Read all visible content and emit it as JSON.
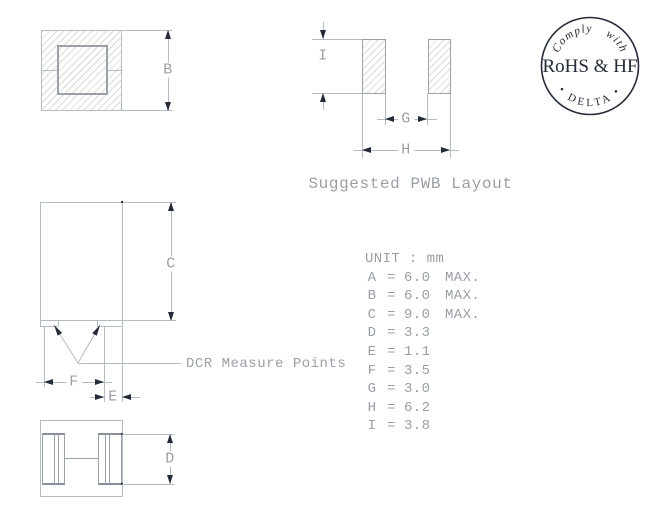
{
  "colors": {
    "line_light": "#b3bbc3",
    "line_mid": "#9aa1a9",
    "ink": "#252b38",
    "text_gray": "#999fa7",
    "hatch": "#d9dbde",
    "background": "#ffffff"
  },
  "views": {
    "top": {
      "dim_b": "B"
    },
    "pwb": {
      "dim_i": "I",
      "dim_g": "G",
      "dim_h": "H",
      "caption": "Suggested PWB Layout"
    },
    "front": {
      "dim_c": "C",
      "dim_f": "F",
      "dim_e": "E",
      "leader": "DCR Measure Points"
    },
    "bottom": {
      "dim_d": "D"
    }
  },
  "table": {
    "title": "UNIT : mm",
    "eq": "=",
    "rows": [
      {
        "name": "A",
        "value": "6.0",
        "note": "MAX."
      },
      {
        "name": "B",
        "value": "6.0",
        "note": "MAX."
      },
      {
        "name": "C",
        "value": "9.0",
        "note": "MAX."
      },
      {
        "name": "D",
        "value": "3.3",
        "note": ""
      },
      {
        "name": "E",
        "value": "1.1",
        "note": ""
      },
      {
        "name": "F",
        "value": "3.5",
        "note": ""
      },
      {
        "name": "G",
        "value": "3.0",
        "note": ""
      },
      {
        "name": "H",
        "value": "6.2",
        "note": ""
      },
      {
        "name": "I",
        "value": "3.8",
        "note": ""
      }
    ]
  },
  "stamp": {
    "arc_top": "Comply with",
    "center": "RoHS & HF",
    "arc_bottom": "• DELTA •"
  }
}
